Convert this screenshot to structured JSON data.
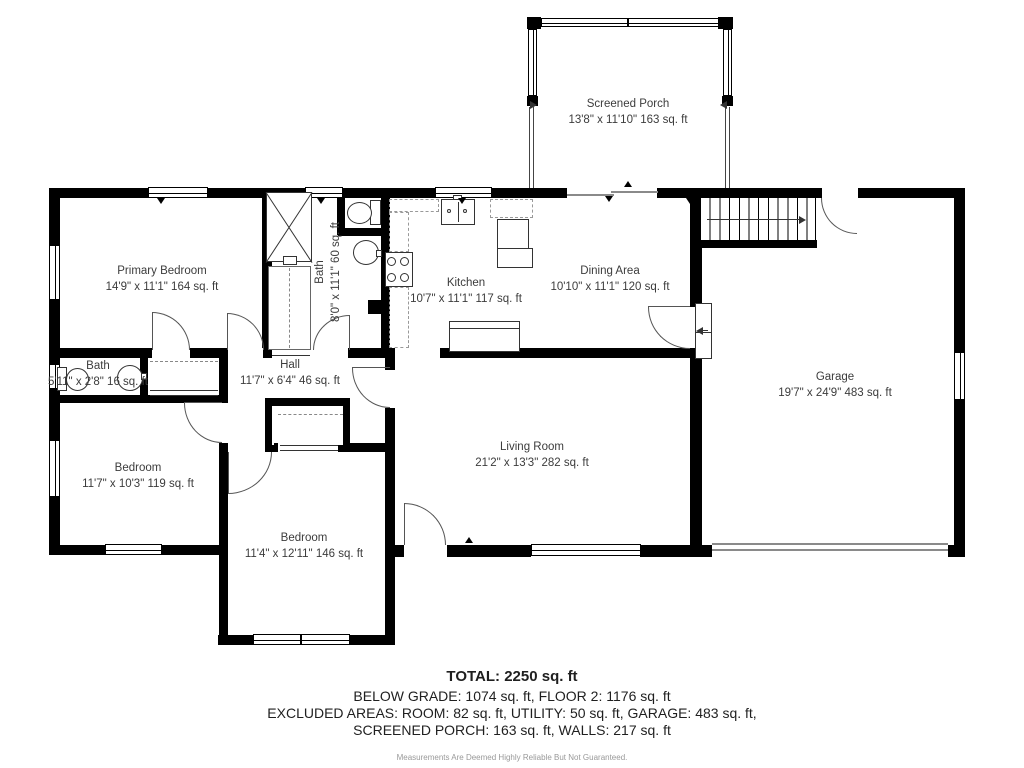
{
  "rooms": {
    "screened_porch": {
      "name": "Screened Porch",
      "dims": "13'8\" x 11'10\" 163 sq. ft"
    },
    "primary_bedroom": {
      "name": "Primary Bedroom",
      "dims": "14'9\" x 11'1\" 164 sq. ft"
    },
    "bath_main": {
      "name": "Bath",
      "dims": "8'0\" x 11'1\" 60 sq. ft"
    },
    "kitchen": {
      "name": "Kitchen",
      "dims": "10'7\" x 11'1\" 117 sq. ft"
    },
    "dining_area": {
      "name": "Dining Area",
      "dims": "10'10\" x 11'1\" 120 sq. ft"
    },
    "garage": {
      "name": "Garage",
      "dims": "19'7\" x 24'9\" 483 sq. ft"
    },
    "bath_small": {
      "name": "Bath",
      "dims": "5'11\" x 2'8\" 16 sq. ft"
    },
    "hall": {
      "name": "Hall",
      "dims": "11'7\" x 6'4\" 46 sq. ft"
    },
    "bedroom_left": {
      "name": "Bedroom",
      "dims": "11'7\" x 10'3\" 119 sq. ft"
    },
    "living_room": {
      "name": "Living Room",
      "dims": "21'2\" x 13'3\" 282 sq. ft"
    },
    "bedroom_bottom": {
      "name": "Bedroom",
      "dims": "11'4\" x 12'11\" 146 sq. ft"
    }
  },
  "summary": {
    "total": "TOTAL: 2250 sq. ft",
    "grade_line": "BELOW GRADE: 1074 sq. ft, FLOOR 2: 1176 sq. ft",
    "excluded_line": "EXCLUDED AREAS: ROOM: 82 sq. ft, UTILITY: 50 sq. ft, GARAGE: 483 sq. ft,",
    "excluded_line2": "SCREENED PORCH: 163 sq. ft, WALLS: 217 sq. ft",
    "disclaimer": "Measurements Are Deemed Highly Reliable But Not Guaranteed."
  },
  "colors": {
    "wall": "#000000",
    "label": "#3c3c3c",
    "door_arc": "#555555",
    "garage_door": "#8a8a8a"
  }
}
